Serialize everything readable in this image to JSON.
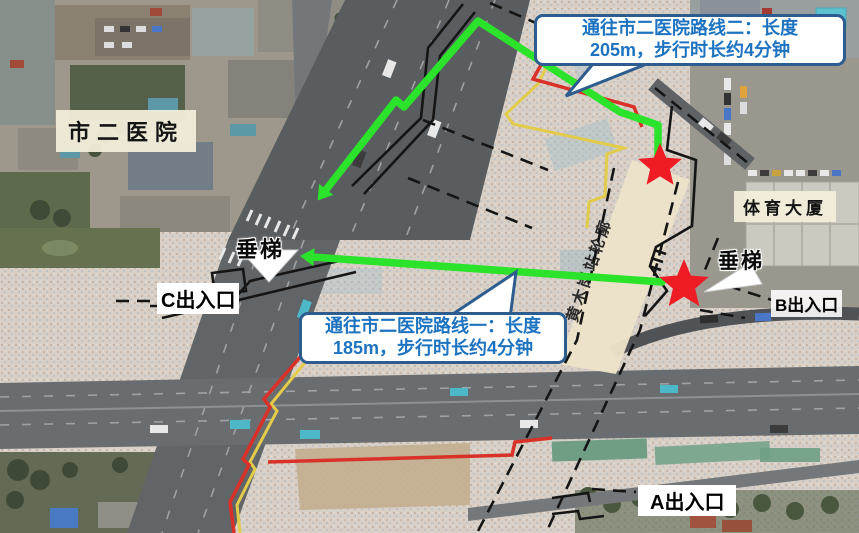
{
  "map": {
    "labels": {
      "hospital": "市二医院",
      "sports_building": "体育大厦",
      "station_band": "黄木岗站轮廓",
      "elevator_left": "垂梯",
      "elevator_right": "垂梯",
      "exit_a": "A出入口",
      "exit_b": "B出入口",
      "exit_c": "C出入口"
    },
    "callouts": {
      "route2": {
        "line1": "通往市二医院路线二：长度",
        "line2": "205m，步行时长约4分钟"
      },
      "route1": {
        "line1": "通往市二医院路线一：长度",
        "line2": "185m，步行时长约4分钟"
      }
    },
    "legend_colors": {
      "route_line_green": "#2ae32a",
      "destination_star_red": "#ee1c24",
      "callout_border_blue": "#2d5c8e",
      "callout_text_blue": "#1d73c0",
      "construction_boundary_red": "#d93028",
      "construction_boundary_yellow": "#e2cc49",
      "station_outline_fill": "#ece3c9"
    }
  }
}
